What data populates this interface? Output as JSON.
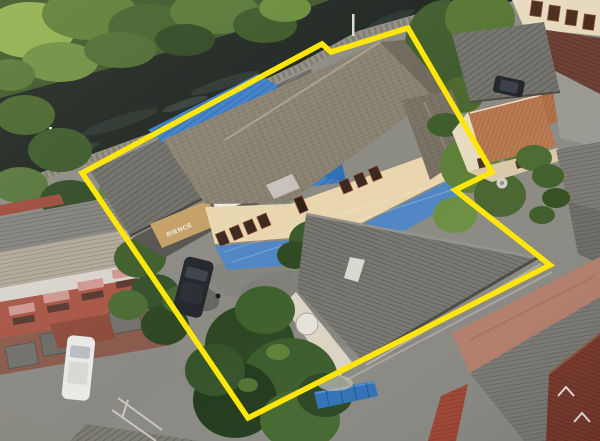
{
  "meta": {
    "type": "aerial-drone-photo",
    "description": "Bird's-eye view of a property plot outlined in yellow: two-storey cream house with grey shingle roof, blue corrugated roofs, workshop with tan shop awning, concrete courtyard with parked dark car, large corrugated warehouse roof; canal with stone embankment and dense tropical vegetation along the top; neighbouring townhouses, terracotta and grey metal roofs around the edges; blue gate at bottom"
  },
  "annotations": {
    "boundary": {
      "points": "82,173 322,44 331,52 408,28 492,172 455,190 550,265 248,418",
      "color": "#ffe60a",
      "width": 5.5
    }
  },
  "signage": {
    "awning_text": "RIENCE"
  },
  "palette": {
    "concrete": "#8b8a83",
    "canal_water": "#1d241f",
    "foliage_base": "#3c5527",
    "roof_gray_dark": "#6f6e67",
    "roof_gray_warehouse": "#77766f",
    "roof_shingle": "#8b8272",
    "roof_blue": "#3c7fca",
    "awning_blue": "#4f86c4",
    "fence_blue": "#2f72b8",
    "roof_terracotta": "#b87a50",
    "roof_dark_red": "#7c392b",
    "roof_salmon": "#b5806b",
    "wall_cream": "#e9d6ae",
    "townhouse_wall": "#a85545",
    "awning_tan": "#c4a066",
    "car_dark": "#23262b",
    "car_white": "#e9e9e6"
  }
}
